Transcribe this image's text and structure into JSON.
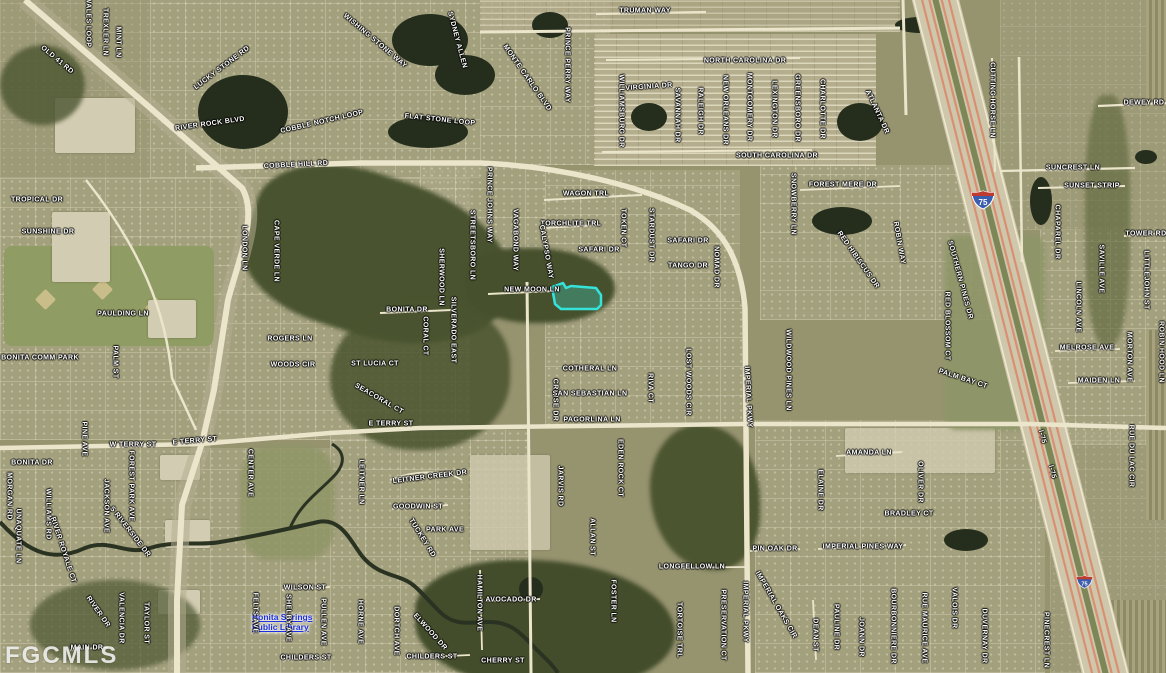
{
  "map": {
    "watermark": "FGCMLS",
    "parcel_highlight_color": "#35e3da",
    "interstate_shield_number": "75",
    "poi": {
      "library_line1": "Bonita Springs",
      "library_line2": "Public Library"
    }
  },
  "labels": [
    {
      "t": "OLD 41 RD",
      "x": 57,
      "y": 60,
      "r": 40
    },
    {
      "t": "WALES LOOP",
      "x": 88,
      "y": 22,
      "r": 90
    },
    {
      "t": "TREXLER LN",
      "x": 105,
      "y": 32,
      "r": 90
    },
    {
      "t": "MINT LN",
      "x": 118,
      "y": 42,
      "r": 90
    },
    {
      "t": "LUCKY STONE RD",
      "x": 222,
      "y": 68,
      "r": -37
    },
    {
      "t": "RIVER ROCK BLVD",
      "x": 210,
      "y": 124,
      "r": -8
    },
    {
      "t": "WISHING STONE WAY",
      "x": 375,
      "y": 41,
      "r": 40
    },
    {
      "t": "COBBLE NOTCH LOOP",
      "x": 322,
      "y": 122,
      "r": -13
    },
    {
      "t": "COBBLE HILL RD",
      "x": 296,
      "y": 165,
      "r": -3
    },
    {
      "t": "FLAT STONE LOOP",
      "x": 440,
      "y": 120,
      "r": 6
    },
    {
      "t": "SYDNEY ALLEN",
      "x": 457,
      "y": 40,
      "r": 75
    },
    {
      "t": "MONTE CARLO BLVD",
      "x": 527,
      "y": 78,
      "r": 55
    },
    {
      "t": "PRINCE PERRY WAY",
      "x": 567,
      "y": 65,
      "r": 90
    },
    {
      "t": "TRUMAN WAY",
      "x": 645,
      "y": 11,
      "r": 0
    },
    {
      "t": "NORTH CAROLINA DR",
      "x": 745,
      "y": 61,
      "r": 0
    },
    {
      "t": "VIRGINIA DR",
      "x": 649,
      "y": 87,
      "r": -4
    },
    {
      "t": "WILLIAMSBURG DR",
      "x": 621,
      "y": 111,
      "r": 90
    },
    {
      "t": "SAVANNAH DR",
      "x": 677,
      "y": 115,
      "r": 90
    },
    {
      "t": "RALEIGH DR",
      "x": 700,
      "y": 111,
      "r": 90
    },
    {
      "t": "NEW ORLEANS DR",
      "x": 725,
      "y": 110,
      "r": 90
    },
    {
      "t": "MONTGOMERY DR",
      "x": 749,
      "y": 107,
      "r": 90
    },
    {
      "t": "LEXINGTON DR",
      "x": 774,
      "y": 109,
      "r": 90
    },
    {
      "t": "GREENSBORO DR",
      "x": 797,
      "y": 108,
      "r": 90
    },
    {
      "t": "CHARLOTTE DR",
      "x": 822,
      "y": 109,
      "r": 90
    },
    {
      "t": "ATLANTA DR",
      "x": 877,
      "y": 112,
      "r": 65
    },
    {
      "t": "SOUTH CAROLINA DR",
      "x": 777,
      "y": 156,
      "r": 0
    },
    {
      "t": "CUTTING HORSE LN",
      "x": 992,
      "y": 100,
      "r": 90
    },
    {
      "t": "DEWEY RD",
      "x": 1144,
      "y": 103,
      "r": 0
    },
    {
      "t": "SUNCREST LN",
      "x": 1073,
      "y": 168,
      "r": 0
    },
    {
      "t": "SUNSET STRIP",
      "x": 1092,
      "y": 186,
      "r": 0
    },
    {
      "t": "TOWER RD",
      "x": 1146,
      "y": 234,
      "r": 0
    },
    {
      "t": "CHAPAREL DR",
      "x": 1057,
      "y": 232,
      "r": 90
    },
    {
      "t": "TROPICAL DR",
      "x": 37,
      "y": 200,
      "r": 0
    },
    {
      "t": "SUNSHINE DR",
      "x": 48,
      "y": 232,
      "r": 0
    },
    {
      "t": "PAULDING LN",
      "x": 123,
      "y": 314,
      "r": 0
    },
    {
      "t": "BONITA COMM PARK",
      "x": 40,
      "y": 358,
      "r": 0
    },
    {
      "t": "LONDON LN",
      "x": 244,
      "y": 248,
      "r": 90
    },
    {
      "t": "CAPE VERDE LN",
      "x": 276,
      "y": 251,
      "r": 90
    },
    {
      "t": "PALM ST",
      "x": 115,
      "y": 362,
      "r": 90
    },
    {
      "t": "WAGON TRL",
      "x": 586,
      "y": 194,
      "r": 0
    },
    {
      "t": "TORCHLITE TRL",
      "x": 571,
      "y": 224,
      "r": 0
    },
    {
      "t": "SAFARI DR",
      "x": 599,
      "y": 250,
      "r": 0
    },
    {
      "t": "SAFARI DR",
      "x": 688,
      "y": 241,
      "r": 0
    },
    {
      "t": "TANGO DR",
      "x": 688,
      "y": 266,
      "r": 0
    },
    {
      "t": "TOKEN CT",
      "x": 623,
      "y": 228,
      "r": 90
    },
    {
      "t": "STARDUST DR",
      "x": 651,
      "y": 235,
      "r": 90
    },
    {
      "t": "NOMAD DR",
      "x": 716,
      "y": 267,
      "r": 90
    },
    {
      "t": "NEW MOON LN",
      "x": 532,
      "y": 290,
      "r": 0
    },
    {
      "t": "CALYPSO WAY",
      "x": 546,
      "y": 252,
      "r": 80
    },
    {
      "t": "PRINCE JOHNS WAY",
      "x": 489,
      "y": 205,
      "r": 90
    },
    {
      "t": "VAGABOND WAY",
      "x": 515,
      "y": 240,
      "r": 90
    },
    {
      "t": "STREETSBORO LN",
      "x": 472,
      "y": 245,
      "r": 90
    },
    {
      "t": "SHERWOOD LN",
      "x": 441,
      "y": 277,
      "r": 90
    },
    {
      "t": "BONITA DR",
      "x": 407,
      "y": 310,
      "r": 0
    },
    {
      "t": "ROGERS LN",
      "x": 290,
      "y": 339,
      "r": 0
    },
    {
      "t": "WOODS CIR",
      "x": 293,
      "y": 365,
      "r": 0
    },
    {
      "t": "ST LUCIA CT",
      "x": 375,
      "y": 364,
      "r": 0
    },
    {
      "t": "SEACORAL CT",
      "x": 379,
      "y": 399,
      "r": 30
    },
    {
      "t": "CORAL CT",
      "x": 425,
      "y": 336,
      "r": 90
    },
    {
      "t": "SILVERADO EAST",
      "x": 453,
      "y": 330,
      "r": 90
    },
    {
      "t": "E TERRY ST",
      "x": 391,
      "y": 424,
      "r": 0
    },
    {
      "t": "CROISE DR",
      "x": 555,
      "y": 400,
      "r": 90
    },
    {
      "t": "COTHERAL LN",
      "x": 590,
      "y": 369,
      "r": 0
    },
    {
      "t": "SAN SEBASTIAN LN",
      "x": 590,
      "y": 394,
      "r": 0
    },
    {
      "t": "PAGORLINA LN",
      "x": 592,
      "y": 420,
      "r": 0
    },
    {
      "t": "RIVA CT",
      "x": 650,
      "y": 388,
      "r": 90
    },
    {
      "t": "LOST WOODS CIR",
      "x": 688,
      "y": 382,
      "r": 90
    },
    {
      "t": "IMPERIAL PKWY",
      "x": 748,
      "y": 397,
      "r": 87
    },
    {
      "t": "WILDWOOD PINES LN",
      "x": 788,
      "y": 370,
      "r": 90
    },
    {
      "t": "EDEN ROCK CT",
      "x": 620,
      "y": 468,
      "r": 90
    },
    {
      "t": "FOREST MERE DR",
      "x": 843,
      "y": 185,
      "r": 0
    },
    {
      "t": "SNOWBERRY LN",
      "x": 793,
      "y": 204,
      "r": 90
    },
    {
      "t": "RED HIBISCUS DR",
      "x": 858,
      "y": 260,
      "r": 55
    },
    {
      "t": "ROBIN WAY",
      "x": 899,
      "y": 243,
      "r": 80
    },
    {
      "t": "SOUTHERN PINES DR",
      "x": 960,
      "y": 280,
      "r": 75
    },
    {
      "t": "RED BLOSSOM CT",
      "x": 947,
      "y": 326,
      "r": 90
    },
    {
      "t": "PALM BAY CT",
      "x": 963,
      "y": 379,
      "r": 18
    },
    {
      "t": "LINCOLN AVE",
      "x": 1078,
      "y": 307,
      "r": 90
    },
    {
      "t": "SAVILLE AVE",
      "x": 1101,
      "y": 269,
      "r": 90
    },
    {
      "t": "MELROSE AVE",
      "x": 1087,
      "y": 348,
      "r": 0
    },
    {
      "t": "MAIDEN LN",
      "x": 1099,
      "y": 381,
      "r": 0
    },
    {
      "t": "MORTON AVE",
      "x": 1129,
      "y": 357,
      "r": 90
    },
    {
      "t": "ROBIN HOOD LN",
      "x": 1161,
      "y": 352,
      "r": 90
    },
    {
      "t": "LITTLEJOHN ST",
      "x": 1146,
      "y": 280,
      "r": 90
    },
    {
      "t": "W TERRY ST",
      "x": 133,
      "y": 445,
      "r": 0
    },
    {
      "t": "E TERRY ST",
      "x": 195,
      "y": 441,
      "r": -5
    },
    {
      "t": "BONITA DR",
      "x": 32,
      "y": 463,
      "r": 0
    },
    {
      "t": "MORGAN RD",
      "x": 9,
      "y": 496,
      "r": 90
    },
    {
      "t": "UNAQUATE LN",
      "x": 18,
      "y": 536,
      "r": 90
    },
    {
      "t": "WILLIAMS RD",
      "x": 48,
      "y": 514,
      "r": 90
    },
    {
      "t": "RIVER ROYALE CT",
      "x": 63,
      "y": 550,
      "r": 72
    },
    {
      "t": "PINE AVE",
      "x": 84,
      "y": 439,
      "r": 90
    },
    {
      "t": "JACKSON AVE",
      "x": 106,
      "y": 506,
      "r": 90
    },
    {
      "t": "FOREST PARK AVE",
      "x": 131,
      "y": 486,
      "r": 90
    },
    {
      "t": "S RIVERSIDE DR",
      "x": 130,
      "y": 532,
      "r": 52
    },
    {
      "t": "RIVER DR",
      "x": 98,
      "y": 612,
      "r": 55
    },
    {
      "t": "VALENCIA DR",
      "x": 121,
      "y": 618,
      "r": 90
    },
    {
      "t": "TAYLOR ST",
      "x": 146,
      "y": 623,
      "r": 90
    },
    {
      "t": "MAIN DR",
      "x": 87,
      "y": 648,
      "r": 0
    },
    {
      "t": "CENTER AVE",
      "x": 250,
      "y": 473,
      "r": 90
    },
    {
      "t": "WILSON ST",
      "x": 305,
      "y": 588,
      "r": 0
    },
    {
      "t": "FELTS AVE",
      "x": 255,
      "y": 613,
      "r": 90
    },
    {
      "t": "SHELBY AVE",
      "x": 288,
      "y": 618,
      "r": 90
    },
    {
      "t": "CHILDERS ST",
      "x": 306,
      "y": 658,
      "r": 0
    },
    {
      "t": "PULLEN AVE",
      "x": 323,
      "y": 622,
      "r": 90
    },
    {
      "t": "LEITNER CREEK DR",
      "x": 430,
      "y": 477,
      "r": -7
    },
    {
      "t": "LEITNER LN",
      "x": 361,
      "y": 482,
      "r": 90
    },
    {
      "t": "GOODWIN ST",
      "x": 418,
      "y": 507,
      "r": 0
    },
    {
      "t": "PARK AVE",
      "x": 445,
      "y": 530,
      "r": 0
    },
    {
      "t": "TUCKEY RD",
      "x": 422,
      "y": 538,
      "r": 58
    },
    {
      "t": "JARVIS RD",
      "x": 560,
      "y": 486,
      "r": 90
    },
    {
      "t": "ALLAN ST",
      "x": 592,
      "y": 537,
      "r": 90
    },
    {
      "t": "HORNE AVE",
      "x": 360,
      "y": 622,
      "r": 90
    },
    {
      "t": "DORTCH AVE",
      "x": 396,
      "y": 631,
      "r": 90
    },
    {
      "t": "ELWOOD DR",
      "x": 430,
      "y": 632,
      "r": 48
    },
    {
      "t": "HAMILTON AVE",
      "x": 479,
      "y": 603,
      "r": 90
    },
    {
      "t": "AVOCADO DR",
      "x": 511,
      "y": 600,
      "r": 0
    },
    {
      "t": "CHILDERS ST",
      "x": 432,
      "y": 657,
      "r": 0
    },
    {
      "t": "CHERRY ST",
      "x": 503,
      "y": 661,
      "r": 0
    },
    {
      "t": "FOSTER LN",
      "x": 613,
      "y": 601,
      "r": 90
    },
    {
      "t": "LONGFELLOW LN",
      "x": 692,
      "y": 567,
      "r": 0
    },
    {
      "t": "AMANDA LN",
      "x": 869,
      "y": 453,
      "r": 0
    },
    {
      "t": "ELAINE DR",
      "x": 820,
      "y": 490,
      "r": 90
    },
    {
      "t": "OLIVER DR",
      "x": 920,
      "y": 482,
      "r": 90
    },
    {
      "t": "BRADLEY CT",
      "x": 909,
      "y": 514,
      "r": 0
    },
    {
      "t": "PIN OAK DR",
      "x": 775,
      "y": 549,
      "r": 0
    },
    {
      "t": "IMPERIAL PINES WAY",
      "x": 863,
      "y": 547,
      "r": 0
    },
    {
      "t": "TORTOISE TRL",
      "x": 679,
      "y": 630,
      "r": 90
    },
    {
      "t": "PRESERVATION CT",
      "x": 723,
      "y": 625,
      "r": 90
    },
    {
      "t": "IMPERIAL PKWY",
      "x": 745,
      "y": 612,
      "r": 90
    },
    {
      "t": "IMPERIAL OAKS CIR",
      "x": 776,
      "y": 605,
      "r": 60
    },
    {
      "t": "DEAN ST",
      "x": 815,
      "y": 635,
      "r": 90
    },
    {
      "t": "PAULINE DR",
      "x": 836,
      "y": 627,
      "r": 90
    },
    {
      "t": "JOANN DR",
      "x": 861,
      "y": 637,
      "r": 90
    },
    {
      "t": "BOURBONNIERE DR",
      "x": 893,
      "y": 626,
      "r": 90
    },
    {
      "t": "RUE MAURICE AVE",
      "x": 924,
      "y": 628,
      "r": 90
    },
    {
      "t": "VALOIS DR",
      "x": 954,
      "y": 608,
      "r": 90
    },
    {
      "t": "DUVERNAY DR",
      "x": 984,
      "y": 636,
      "r": 90
    },
    {
      "t": "PINECREST LN",
      "x": 1046,
      "y": 640,
      "r": 90
    },
    {
      "t": "RUE DU LAC CIR",
      "x": 1131,
      "y": 456,
      "r": 90
    },
    {
      "t": "I-75",
      "x": 1052,
      "y": 472,
      "r": 75
    },
    {
      "t": "I-75",
      "x": 1042,
      "y": 437,
      "r": 75
    }
  ]
}
